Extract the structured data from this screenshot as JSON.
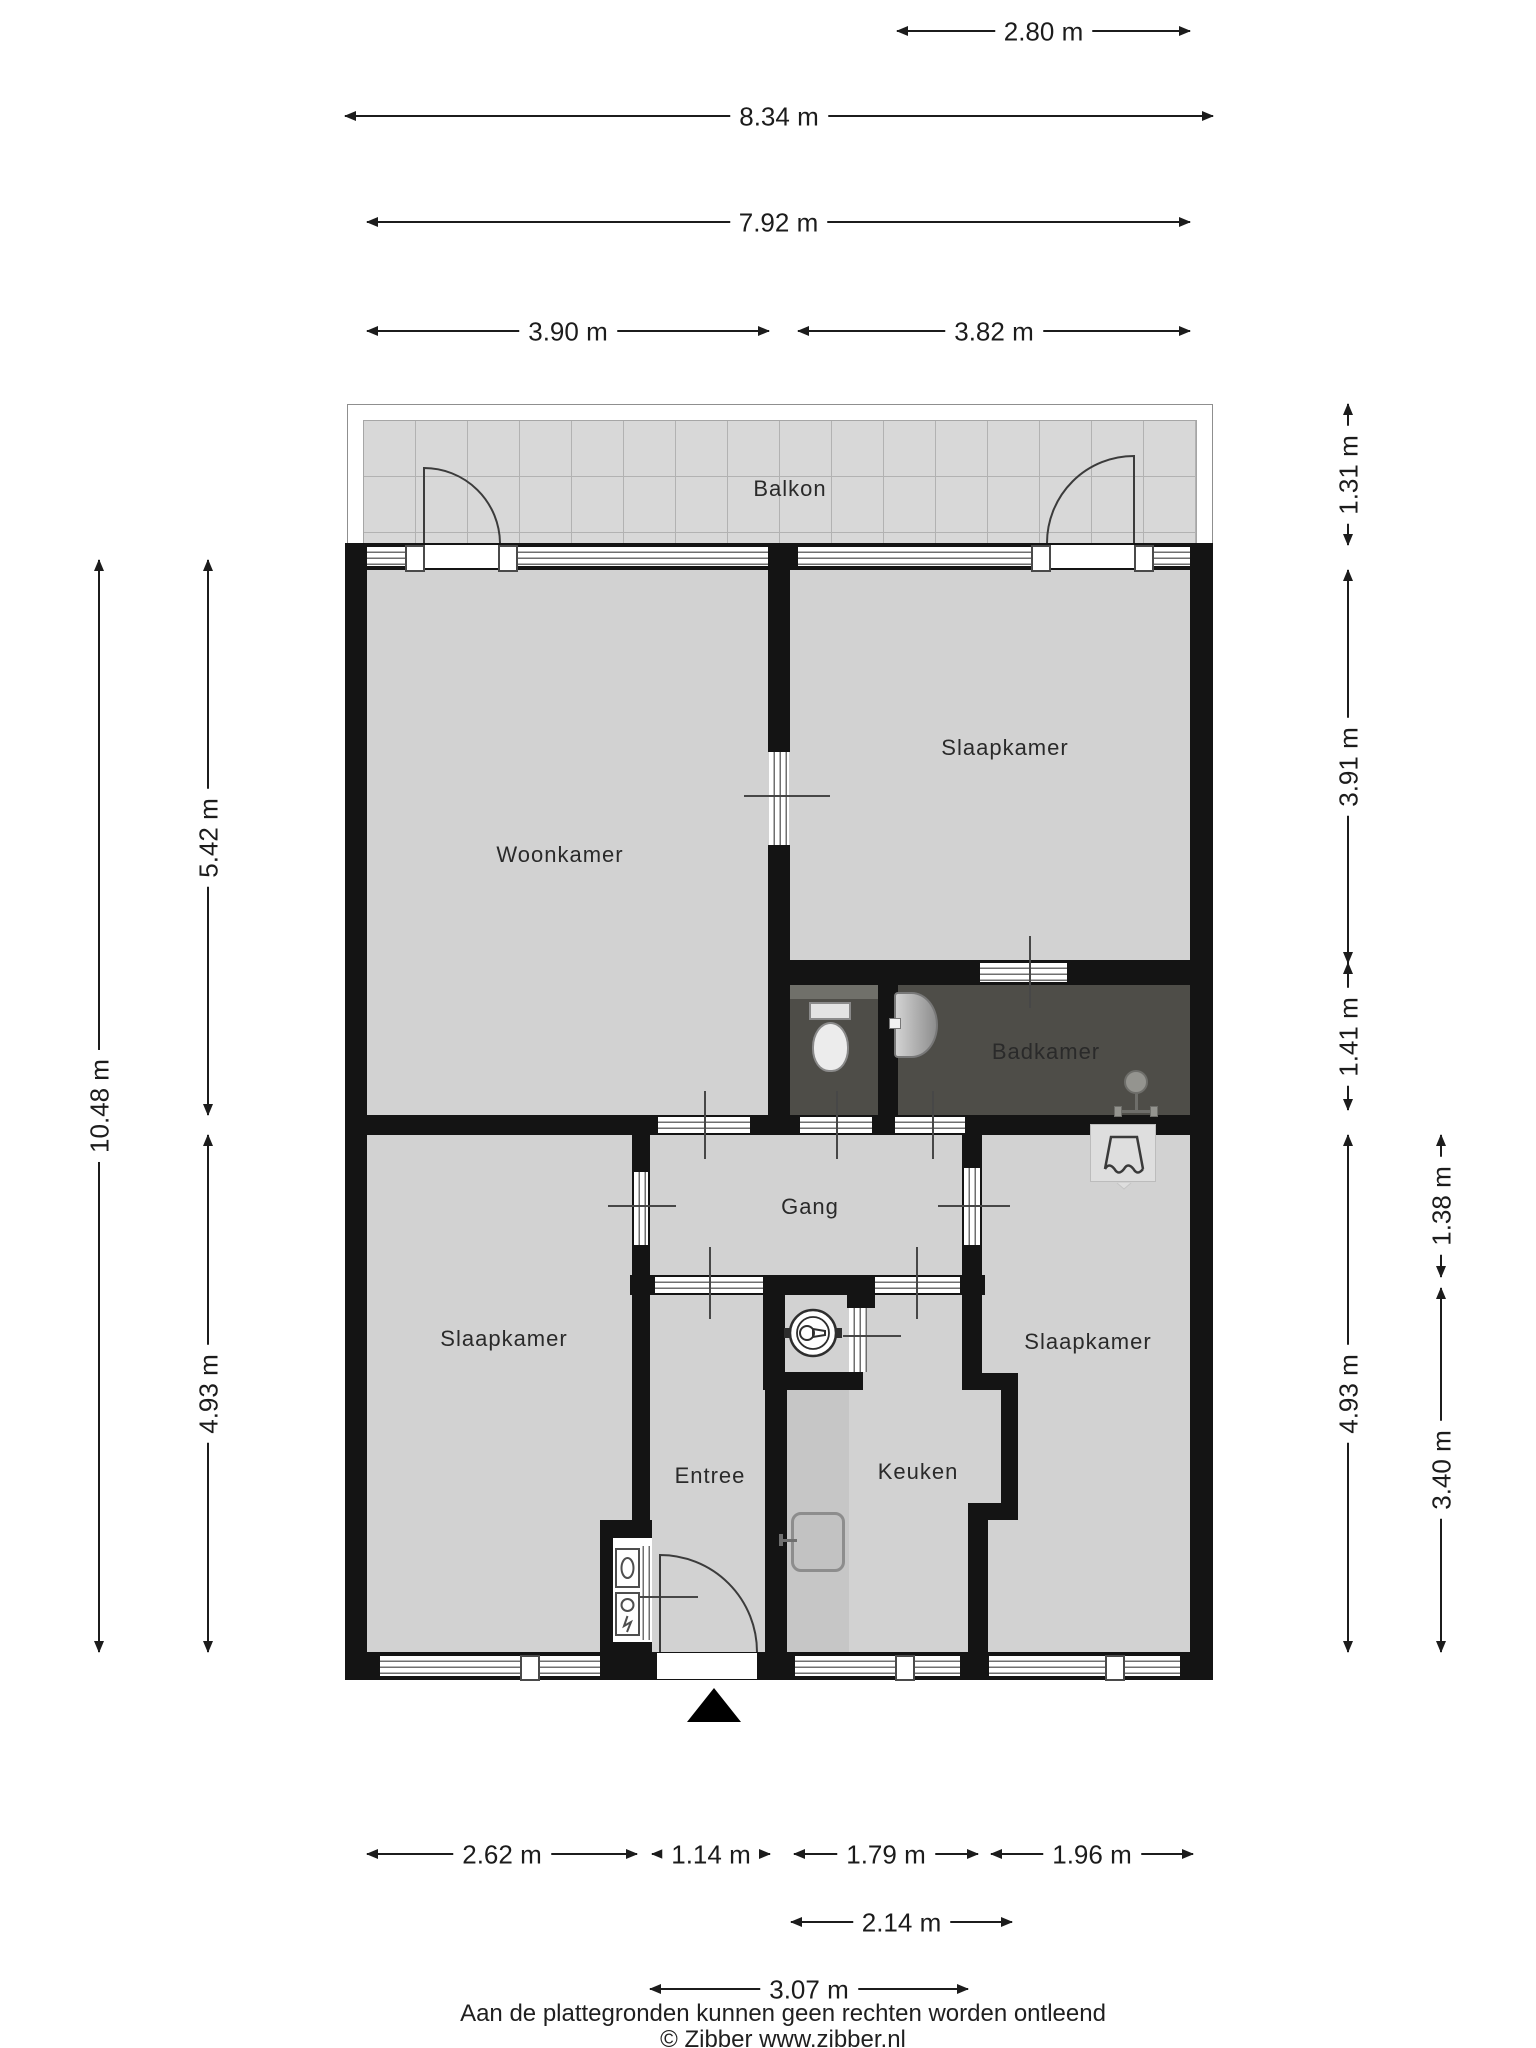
{
  "plan": {
    "rooms": [
      {
        "id": "balkon",
        "label": "Balkon"
      },
      {
        "id": "woonkamer",
        "label": "Woonkamer"
      },
      {
        "id": "slaapkamer-top",
        "label": "Slaapkamer"
      },
      {
        "id": "badkamer",
        "label": "Badkamer"
      },
      {
        "id": "gang",
        "label": "Gang"
      },
      {
        "id": "slaapkamer-left",
        "label": "Slaapkamer"
      },
      {
        "id": "entree",
        "label": "Entree"
      },
      {
        "id": "keuken",
        "label": "Keuken"
      },
      {
        "id": "slaapkamer-right",
        "label": "Slaapkamer"
      }
    ],
    "icons": [
      "toilet-icon",
      "washbasin-icon",
      "shower-icon",
      "wardrobe-icon",
      "boiler-icon",
      "meter-icon",
      "kitchen-sink-icon",
      "entrance-arrow-icon"
    ]
  },
  "dims": {
    "top_280": "2.80 m",
    "top_834": "8.34 m",
    "top_792": "7.92 m",
    "top_390": "3.90 m",
    "top_382": "3.82 m",
    "left_1048": "10.48 m",
    "left_542": "5.42 m",
    "left_493": "4.93 m",
    "right_131": "1.31 m",
    "right_391": "3.91 m",
    "right_141": "1.41 m",
    "right_493": "4.93 m",
    "right_138": "1.38 m",
    "right_340": "3.40 m",
    "bottom_262": "2.62 m",
    "bottom_114": "1.14 m",
    "bottom_179": "1.79 m",
    "bottom_196": "1.96 m",
    "bottom_214": "2.14 m",
    "bottom_307": "3.07 m"
  },
  "footer": {
    "disclaimer": "Aan de plattegronden kunnen geen rechten worden ontleend",
    "copyright": "© Zibber www.zibber.nl"
  },
  "colors": {
    "wall": "#141414",
    "floor": "#d2d2d2",
    "floor_dark": "#4e4d48",
    "balcony_floor": "#d8d8d8",
    "counter": "#c6c6c6",
    "dimension_text": "#1c1c1c"
  }
}
